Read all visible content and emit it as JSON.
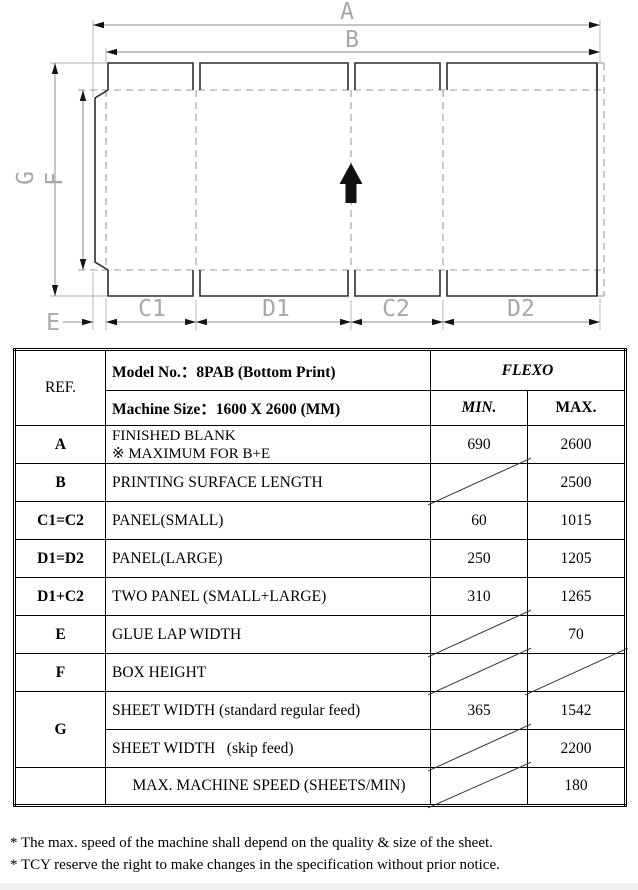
{
  "diagram": {
    "labels": {
      "a": "A",
      "b": "B",
      "g": "G",
      "f": "F",
      "e": "E",
      "c1": "C1",
      "d1": "D1",
      "c2": "C2",
      "d2": "D2"
    }
  },
  "table": {
    "header": {
      "ref": "REF.",
      "model": "Model No.：8PAB (Bottom Print)",
      "machine": "Machine Size：1600 X 2600 (MM)",
      "flexo": "FLEXO",
      "min": "MIN.",
      "max": "MAX."
    },
    "rows": [
      {
        "ref": "A",
        "desc": "FINISHED BLANK",
        "desc2": "※ MAXIMUM FOR B+E",
        "min": "690",
        "max": "2600",
        "min_na": false,
        "max_na": false
      },
      {
        "ref": "B",
        "desc": "PRINTING SURFACE LENGTH",
        "min": "",
        "max": "2500",
        "min_na": true,
        "max_na": false
      },
      {
        "ref": "C1=C2",
        "desc": "PANEL(SMALL)",
        "min": "60",
        "max": "1015",
        "min_na": false,
        "max_na": false
      },
      {
        "ref": "D1=D2",
        "desc": "PANEL(LARGE)",
        "min": "250",
        "max": "1205",
        "min_na": false,
        "max_na": false
      },
      {
        "ref": "D1+C2",
        "desc": "TWO PANEL (SMALL+LARGE)",
        "min": "310",
        "max": "1265",
        "min_na": false,
        "max_na": false
      },
      {
        "ref": "E",
        "desc": "GLUE LAP WIDTH",
        "min": "",
        "max": "70",
        "min_na": true,
        "max_na": false
      },
      {
        "ref": "F",
        "desc": "BOX HEIGHT",
        "min": "",
        "max": "",
        "min_na": true,
        "max_na": true
      },
      {
        "ref": "G",
        "desc": "SHEET WIDTH (standard regular feed)",
        "min": "365",
        "max": "1542",
        "min_na": false,
        "max_na": false
      },
      {
        "ref": "",
        "desc": "SHEET WIDTH   (skip feed)",
        "min": "",
        "max": "2200",
        "min_na": true,
        "max_na": false
      },
      {
        "ref": "",
        "desc": "MAX. MACHINE SPEED (SHEETS/MIN)",
        "min": "",
        "max": "180",
        "min_na": true,
        "max_na": false
      }
    ]
  },
  "footnotes": {
    "line1": "* The max. speed of the machine shall depend on the quality & size of the sheet.",
    "line2": "* TCY reserve the right to make changes in the specification without prior notice."
  }
}
